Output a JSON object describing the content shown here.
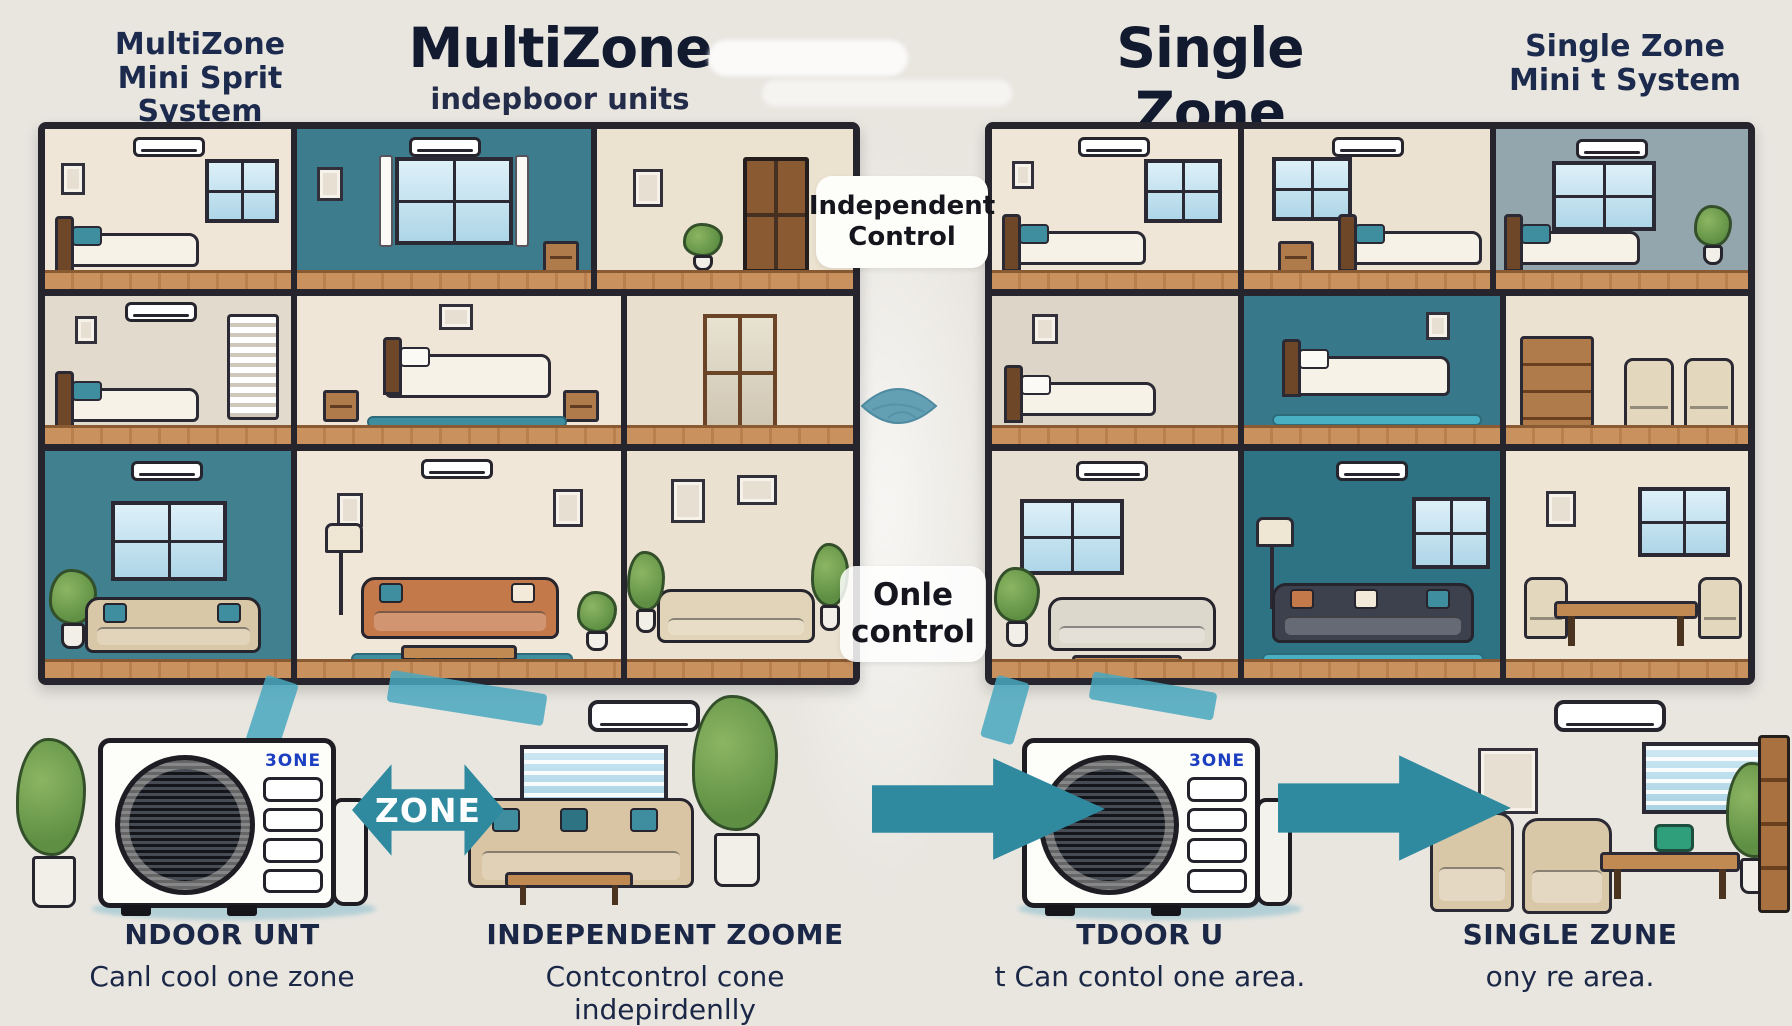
{
  "colors": {
    "background": "#e9e6e0",
    "ink_navy": "#1c2a4d",
    "title_dark": "#121a30",
    "teal_arrow": "#2f8aa0",
    "teal_wall": "#3c7c8d",
    "badge_blue": "#1b3fc0",
    "wood_floor": "#c8915e"
  },
  "headers": {
    "far_left": {
      "line1": "MultiZone",
      "line2": "Mini Sprit System"
    },
    "multizone": {
      "title": "MultiZone",
      "subtitle": "indepboor units"
    },
    "singlezone": {
      "title": "Single Zone",
      "subtitle_prefix": "one",
      "subtitle_rest": "outdoor syntem"
    },
    "far_right": {
      "line1": "Single Zone",
      "line2": "Mini t System"
    }
  },
  "middle": {
    "independent_line1": "Independent",
    "independent_line2": "Control",
    "one_line1": "Onle",
    "one_line2": "control"
  },
  "bottom": {
    "unit_badge_left": "3ONE",
    "unit_badge_right": "3ONE",
    "zone_arrow": "ZONE",
    "one_arrow_1": "ONE",
    "one_arrow_2": "ONE",
    "captions": [
      {
        "title": "NDOOR UNT",
        "subtitle": "Canl cool one zone"
      },
      {
        "title": "INDEPENDENT ZOOME",
        "subtitle": "Contcontrol cone indepirdenlly"
      },
      {
        "title": "TDOOR U",
        "subtitle": "t Can contol one area."
      },
      {
        "title": "SINGLE ZUNE",
        "subtitle": "ony re area."
      }
    ]
  },
  "icons": {
    "leaf-icon": "teal lens/leaf shape",
    "zone-arrow-icon": "double-headed teal arrow",
    "one-arrow-icon": "right-pointing teal arrow",
    "wall-ac-unit-icon": "white wall-mounted mini-split bar",
    "outdoor-unit-icon": "condenser box with round fan grille"
  }
}
